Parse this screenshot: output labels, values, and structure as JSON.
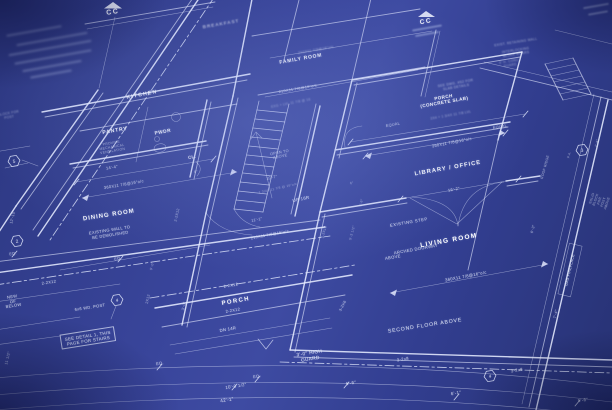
{
  "scene": {
    "description": "Photograph of an architectural blueprint first-floor plan at an oblique angle; white drafting linework and lettering on blue print paper",
    "colors": {
      "paper": "#33408c",
      "line": "#e6ecff",
      "text": "#f5f8ff"
    }
  },
  "cc_markers": [
    {
      "label": "CC",
      "x": 113,
      "y": 13
    },
    {
      "label": "CC",
      "x": 426,
      "y": 22
    }
  ],
  "hexagon_markers": [
    {
      "n": "5",
      "x": 14,
      "y": 161
    },
    {
      "n": "2",
      "x": 17,
      "y": 241
    },
    {
      "n": "4",
      "x": 117,
      "y": 300
    },
    {
      "n": "4",
      "x": 490,
      "y": 376
    },
    {
      "n": "3",
      "x": 582,
      "y": 150
    }
  ],
  "labels": [
    {
      "t": "CC",
      "x": 113,
      "y": 13,
      "s": 7,
      "w": 700,
      "o": 0.95,
      "ls": 1.5,
      "r": -9
    },
    {
      "t": "CC",
      "x": 426,
      "y": 22,
      "s": 6.5,
      "w": 700,
      "o": 0.9,
      "ls": 1.5,
      "r": -10
    },
    {
      "t": "BREAKFAST",
      "x": 221,
      "y": 24,
      "s": 4.6,
      "w": 700,
      "o": 0.55,
      "ls": 1,
      "r": -10,
      "bl": 1
    },
    {
      "t": "210X11 7/8@16\"o/c",
      "x": 316,
      "y": 50,
      "s": 3.5,
      "o": 0.5,
      "r": -10,
      "bl": 1
    },
    {
      "t": "FAMILY ROOM",
      "x": 301,
      "y": 60,
      "s": 5,
      "w": 700,
      "o": 0.9,
      "ls": 0.8,
      "r": -10
    },
    {
      "t": "210X11 7/8@16\"o/c",
      "x": 298,
      "y": 89,
      "s": 3.8,
      "o": 0.65,
      "r": -10
    },
    {
      "t": "KITCHEN",
      "x": 142,
      "y": 95,
      "s": 5.2,
      "w": 700,
      "o": 0.85,
      "ls": 1.2,
      "r": -11
    },
    {
      "t": "PANTRY",
      "x": 115,
      "y": 131,
      "s": 5.2,
      "w": 700,
      "o": 0.9,
      "ls": 0.8,
      "r": -10
    },
    {
      "t": "PROVIDE\nMECHANICAL\nVENTILATION",
      "x": 112,
      "y": 147,
      "s": 3.4,
      "o": 0.55,
      "r": -10
    },
    {
      "t": "PWDR",
      "x": 163,
      "y": 133,
      "s": 4.8,
      "w": 700,
      "o": 0.9,
      "ls": 0.5,
      "r": -10
    },
    {
      "t": "CL.",
      "x": 192,
      "y": 157,
      "s": 4.4,
      "w": 700,
      "o": 0.85,
      "r": -10
    },
    {
      "t": "OPEN TO\nABOVE",
      "x": 280,
      "y": 155,
      "s": 3.8,
      "o": 0.65,
      "r": -11
    },
    {
      "t": "10'-7\"",
      "x": 272,
      "y": 178,
      "s": 3.8,
      "o": 0.65,
      "r": -13
    },
    {
      "t": "1 3/4X 11 7/8 @ 16\"o/c",
      "x": 278,
      "y": 189,
      "s": 3.2,
      "o": 0.45,
      "r": -13
    },
    {
      "t": "UP 16R",
      "x": 301,
      "y": 199,
      "s": 4.4,
      "o": 0.85,
      "r": -12
    },
    {
      "t": "EXG + LVL 11 7/8 @ 16",
      "x": 291,
      "y": 104,
      "s": 3.2,
      "o": 0.45,
      "r": -11,
      "bl": 1
    },
    {
      "t": "SEE DWG. #S2 FOR\nSLAB DETAILS",
      "x": 456,
      "y": 86,
      "s": 3.3,
      "o": 0.55,
      "r": -10,
      "bl": 1
    },
    {
      "t": "PORCH\n(CONCRETE SLAB)",
      "x": 444,
      "y": 100,
      "s": 4.6,
      "w": 700,
      "o": 0.92,
      "ls": 0.4,
      "r": -10
    },
    {
      "t": "2X4 + 1 3/4X 11 7/8 LVL",
      "x": 451,
      "y": 116,
      "s": 3.2,
      "o": 0.5,
      "r": -10,
      "bl": 1
    },
    {
      "t": "EQUAL",
      "x": 393,
      "y": 125,
      "s": 3.8,
      "o": 0.7,
      "r": -11
    },
    {
      "t": "EQUAL",
      "x": 500,
      "y": 127,
      "s": 3.8,
      "o": 0.7,
      "r": -11
    },
    {
      "t": "360X11 7/8@16\"o/c",
      "x": 452,
      "y": 143,
      "s": 4,
      "o": 0.75,
      "r": -11
    },
    {
      "t": "LIBRARY / OFFICE",
      "x": 448,
      "y": 169,
      "s": 5.8,
      "w": 700,
      "o": 0.95,
      "ls": 1,
      "r": -10
    },
    {
      "t": "16'-2\"",
      "x": 454,
      "y": 190,
      "s": 4,
      "o": 0.75,
      "r": -11
    },
    {
      "t": "EXIST. RETAINING WALL",
      "x": 516,
      "y": 43,
      "s": 3.2,
      "o": 0.5,
      "r": -9,
      "bl": 1
    },
    {
      "t": "INTERLOCKING\nBLOCK STAIRS",
      "x": 516,
      "y": 53,
      "s": 3.2,
      "o": 0.5,
      "r": -9,
      "bl": 1
    },
    {
      "t": "6' H. CONC.\nGUARD",
      "x": 510,
      "y": 64,
      "s": 3.2,
      "o": 0.45,
      "r": -9,
      "bl": 1
    },
    {
      "t": "ROOF RIDGE",
      "x": 545,
      "y": 167,
      "s": 3.4,
      "o": 0.6,
      "r": -75
    },
    {
      "t": "1'-6\"",
      "x": 597,
      "y": 143,
      "s": 3.4,
      "o": 0.6,
      "r": -75
    },
    {
      "t": "P.A.",
      "x": 570,
      "y": 155,
      "s": 3.2,
      "o": 0.5,
      "r": -75
    },
    {
      "t": "SOLID BLOCK FOR\nPOST ABOVE",
      "x": 600,
      "y": 201,
      "s": 3.3,
      "o": 0.55,
      "r": -72
    },
    {
      "t": "6'-3\"",
      "x": 533,
      "y": 229,
      "s": 3.6,
      "o": 0.6,
      "r": -75
    },
    {
      "t": "GAS FIREPLACE",
      "x": 570,
      "y": 270,
      "s": 3.6,
      "o": 0.85,
      "r": -77
    },
    {
      "t": "7'-4\"",
      "x": 556,
      "y": 314,
      "s": 3.8,
      "o": 0.7,
      "r": -77
    },
    {
      "t": "14'-4\"",
      "x": 112,
      "y": 168,
      "s": 4,
      "o": 0.75,
      "r": -10
    },
    {
      "t": "360X11 7/8@16\"o/c",
      "x": 124,
      "y": 185,
      "s": 4,
      "o": 0.75,
      "r": -10
    },
    {
      "t": "6\"",
      "x": 196,
      "y": 172,
      "s": 3.5,
      "o": 0.6,
      "r": -10
    },
    {
      "t": "DINING ROOM",
      "x": 109,
      "y": 216,
      "s": 6,
      "w": 700,
      "o": 0.95,
      "ls": 1,
      "r": -9
    },
    {
      "t": "EXISTING WALL TO\nBE DEMOLISHED",
      "x": 110,
      "y": 233,
      "s": 4,
      "o": 0.8,
      "r": -9
    },
    {
      "t": "12'-10\"",
      "x": 13,
      "y": 217,
      "s": 3.8,
      "o": 0.6,
      "r": -76
    },
    {
      "t": "EQ.",
      "x": 13,
      "y": 254,
      "s": 3.8,
      "o": 0.7,
      "r": -9
    },
    {
      "t": "EQ.",
      "x": 118,
      "y": 259,
      "s": 3.8,
      "o": 0.75,
      "r": -9
    },
    {
      "t": "2-2X12",
      "x": 49,
      "y": 283,
      "s": 4,
      "o": 0.8,
      "r": -9
    },
    {
      "t": "NEW\nOF\nBELOW",
      "x": 13,
      "y": 302,
      "s": 4,
      "o": 0.8,
      "r": -9
    },
    {
      "t": "6x6 WD. POST",
      "x": 90,
      "y": 308,
      "s": 4,
      "o": 0.8,
      "r": -9
    },
    {
      "t": "SEE DETAIL 1, THIS\nPAGE FOR STAIRS",
      "x": 88,
      "y": 338,
      "s": 4.4,
      "o": 0.85,
      "r": -9,
      "bx": 1
    },
    {
      "t": "11 1/2\"",
      "x": 8,
      "y": 358,
      "s": 3.8,
      "o": 0.6,
      "r": -76
    },
    {
      "t": "2X12",
      "x": 148,
      "y": 299,
      "s": 3.6,
      "o": 0.6,
      "r": -77
    },
    {
      "t": "2-2X12",
      "x": 177,
      "y": 215,
      "s": 3.6,
      "o": 0.6,
      "r": -77
    },
    {
      "t": "3'-0\"",
      "x": 184,
      "y": 306,
      "s": 3.6,
      "o": 0.65,
      "r": -77
    },
    {
      "t": "9'-0\"",
      "x": 152,
      "y": 266,
      "s": 3.4,
      "o": 0.5,
      "r": -77
    },
    {
      "t": "2-2X12",
      "x": 231,
      "y": 286,
      "s": 4,
      "o": 0.8,
      "r": -10
    },
    {
      "t": "PORCH",
      "x": 236,
      "y": 302,
      "s": 6,
      "w": 700,
      "o": 0.95,
      "ls": 1.4,
      "r": -10
    },
    {
      "t": "2-2X12",
      "x": 233,
      "y": 311,
      "s": 4,
      "o": 0.8,
      "r": -10
    },
    {
      "t": "DN 14R",
      "x": 228,
      "y": 330,
      "s": 4.2,
      "o": 0.85,
      "r": -10
    },
    {
      "t": "3'-0\" HIGH\nGUARD",
      "x": 310,
      "y": 357,
      "s": 4.8,
      "o": 0.9,
      "r": -9
    },
    {
      "t": "EQ.",
      "x": 160,
      "y": 364,
      "s": 4,
      "o": 0.75,
      "r": -9
    },
    {
      "t": "EQ.",
      "x": 257,
      "y": 377,
      "s": 4,
      "o": 0.75,
      "r": -9
    },
    {
      "t": "10'-0 1/2\"",
      "x": 236,
      "y": 386,
      "s": 4.4,
      "o": 0.8,
      "r": -9
    },
    {
      "t": "42'-1\"",
      "x": 227,
      "y": 400,
      "s": 4.6,
      "o": 0.85,
      "r": -9
    },
    {
      "t": "210X11 7/8@16\"o/c",
      "x": 270,
      "y": 235,
      "s": 3.8,
      "o": 0.7,
      "r": -11
    },
    {
      "t": "11'-1\"",
      "x": 257,
      "y": 220,
      "s": 3.8,
      "o": 0.7,
      "r": -11
    },
    {
      "t": "EXISTING STEP",
      "x": 409,
      "y": 223,
      "s": 4.2,
      "o": 0.85,
      "ls": 0.5,
      "r": -10
    },
    {
      "t": "LIVING ROOM",
      "x": 449,
      "y": 241,
      "s": 6.5,
      "w": 700,
      "o": 1,
      "ls": 1.3,
      "r": -10
    },
    {
      "t": "ARCHED  DOORWAY",
      "x": 416,
      "y": 250,
      "s": 4.2,
      "o": 0.8,
      "r": -10
    },
    {
      "t": "ABOVE",
      "x": 393,
      "y": 258,
      "s": 4.2,
      "o": 0.8,
      "r": -10
    },
    {
      "t": "360X11 7/8@16\"o/c",
      "x": 466,
      "y": 277,
      "s": 4.2,
      "o": 0.8,
      "r": -11
    },
    {
      "t": "3-2X6",
      "x": 343,
      "y": 306,
      "s": 3.8,
      "o": 0.7,
      "r": -62
    },
    {
      "t": "SECOND FLOOR ABOVE",
      "x": 425,
      "y": 326,
      "s": 5.2,
      "o": 0.9,
      "ls": 0.8,
      "r": -9
    },
    {
      "t": "3-2x8",
      "x": 403,
      "y": 360,
      "s": 4.2,
      "o": 0.8,
      "r": -9
    },
    {
      "t": "3-2x8",
      "x": 517,
      "y": 371,
      "s": 4.2,
      "o": 0.8,
      "r": -9
    },
    {
      "t": "5'-6\"",
      "x": 351,
      "y": 383,
      "s": 4.4,
      "o": 0.8,
      "r": -9
    },
    {
      "t": "6'-1\"",
      "x": 456,
      "y": 393,
      "s": 4.4,
      "o": 0.8,
      "r": -9
    },
    {
      "t": "5'-6\"",
      "x": 583,
      "y": 400,
      "s": 4.4,
      "o": 0.8,
      "r": -8
    },
    {
      "t": "2-2X12",
      "x": 324,
      "y": 232,
      "s": 3.4,
      "o": 0.55,
      "r": -75
    },
    {
      "t": "5'-3 1/2\"",
      "x": 353,
      "y": 233,
      "s": 3.3,
      "o": 0.5,
      "r": -75
    },
    {
      "t": "1'-6\"",
      "x": 362,
      "y": 203,
      "s": 3.3,
      "o": 0.5,
      "r": -75
    },
    {
      "t": "6\"",
      "x": 352,
      "y": 184,
      "s": 3.3,
      "o": 0.5,
      "r": -11
    },
    {
      "t": "BLOCK FOR\nPOST",
      "x": 9,
      "y": 116,
      "s": 3.2,
      "o": 0.45,
      "r": -10,
      "bl": 1
    }
  ]
}
